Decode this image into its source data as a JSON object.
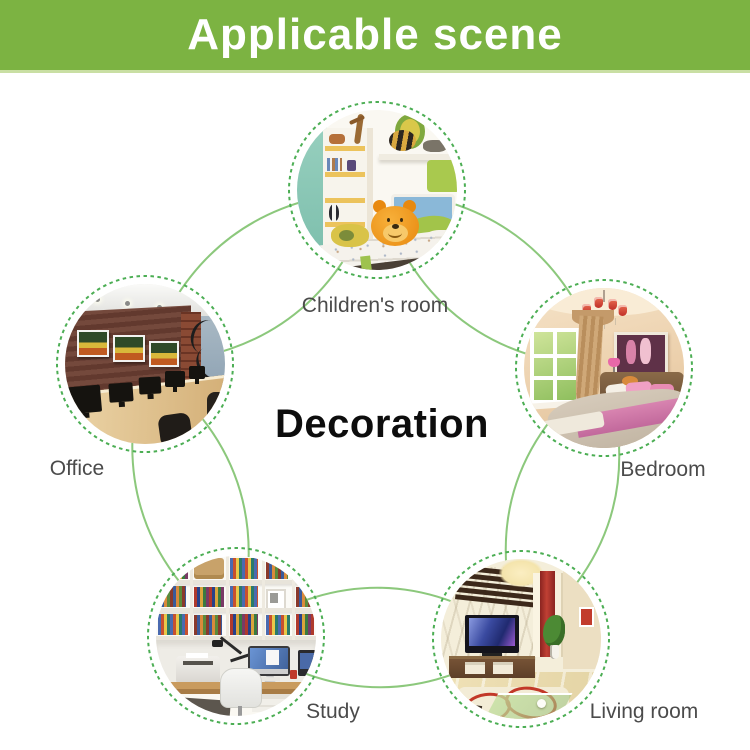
{
  "header": {
    "title": "Applicable scene",
    "background_color": "#7cb342",
    "text_color": "#ffffff"
  },
  "diagram": {
    "center_label": "Decoration",
    "scenes": [
      {
        "id": "children-room",
        "label": "Children's room",
        "position": "top"
      },
      {
        "id": "bedroom",
        "label": "Bedroom",
        "position": "upper-right"
      },
      {
        "id": "living-room",
        "label": "Living room",
        "position": "lower-right"
      },
      {
        "id": "study",
        "label": "Study",
        "position": "lower-left"
      },
      {
        "id": "office",
        "label": "Office",
        "position": "upper-left"
      }
    ],
    "colors": {
      "connector_line": "#8cc87c",
      "ring_dash": "#4cae54",
      "label_text": "#4b4b4b",
      "center_text": "#0d0d0d"
    }
  }
}
